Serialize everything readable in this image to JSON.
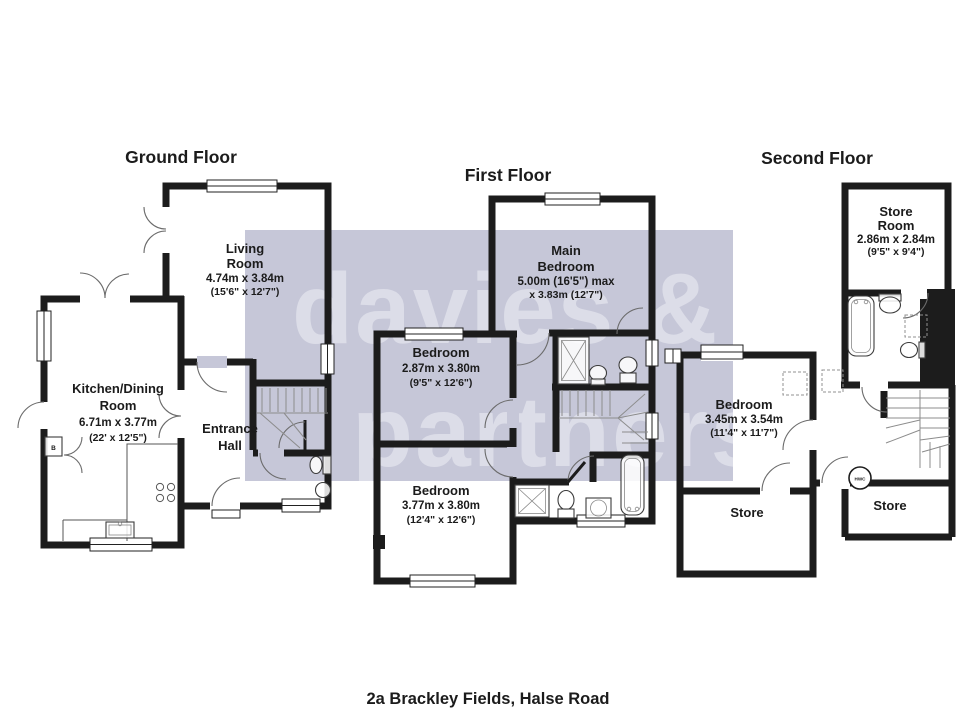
{
  "page": {
    "address": "2a Brackley Fields, Halse Road"
  },
  "watermark": {
    "line1": "davies &",
    "line2": "partners"
  },
  "ground": {
    "title": "Ground Floor",
    "living": {
      "l1": "Living",
      "l2": "Room",
      "m": "4.74m x 3.84m",
      "ft": "(15'6\" x 12'7\")"
    },
    "kitchen": {
      "l1": "Kitchen/Dining",
      "l2": "Room",
      "m": "6.71m x 3.77m",
      "ft": "(22' x 12'5\")"
    },
    "entrance": {
      "l1": "Entrance",
      "l2": "Hall"
    },
    "boiler": "B"
  },
  "first": {
    "title": "First Floor",
    "main": {
      "l1": "Main",
      "l2": "Bedroom",
      "m": "5.00m (16'5\") max",
      "ft": "x 3.83m (12'7\")"
    },
    "bed2": {
      "l1": "Bedroom",
      "m": "2.87m x 3.80m",
      "ft": "(9'5\" x 12'6\")"
    },
    "bed3": {
      "l1": "Bedroom",
      "m": "3.77m x 3.80m",
      "ft": "(12'4\" x 12'6\")"
    }
  },
  "second": {
    "title": "Second Floor",
    "store_room": {
      "l1": "Store",
      "l2": "Room",
      "m": "2.86m x 2.84m",
      "ft": "(9'5\" x 9'4\")"
    },
    "bedroom": {
      "l1": "Bedroom",
      "m": "3.45m x 3.54m",
      "ft": "(11'4\" x 11'7\")"
    },
    "store_left": "Store",
    "store_right": "Store",
    "hwc": "HWC"
  }
}
